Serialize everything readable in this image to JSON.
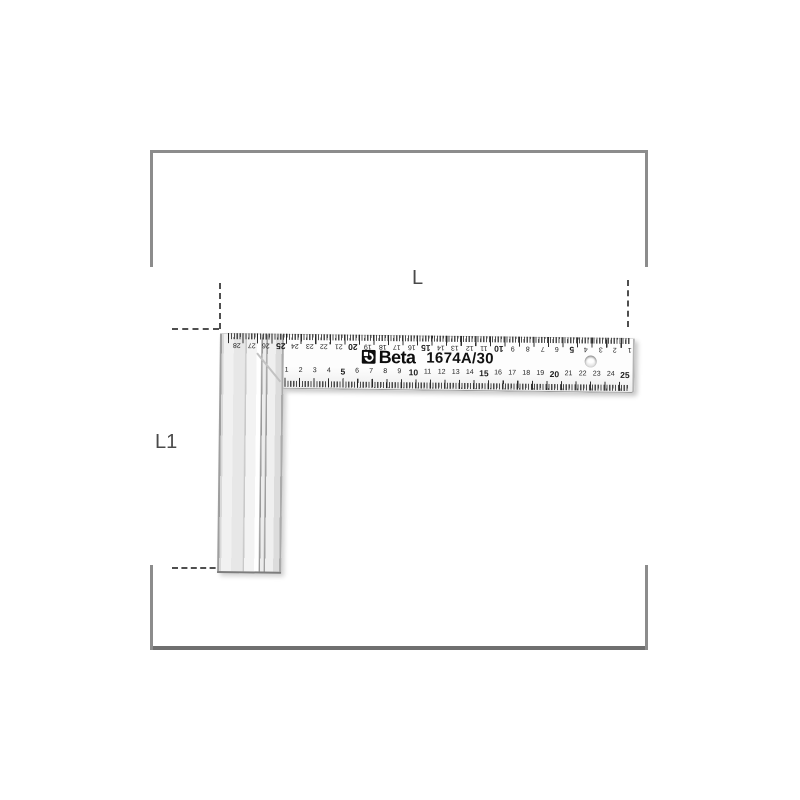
{
  "product": {
    "brand": "Beta",
    "model": "1674A/30"
  },
  "dimension_labels": {
    "length": "L",
    "height": "L1"
  },
  "ruler_scales": {
    "bottom_numbers": [
      1,
      2,
      3,
      4,
      5,
      6,
      7,
      8,
      9,
      10,
      11,
      12,
      13,
      14,
      15,
      16,
      17,
      18,
      19,
      20,
      21,
      22,
      23,
      24,
      25
    ],
    "top_numbers": [
      28,
      27,
      26,
      25,
      24,
      23,
      22,
      21,
      20,
      19,
      18,
      17,
      16,
      15,
      14,
      13,
      12,
      11,
      10,
      9,
      8,
      7,
      6,
      5,
      4,
      3,
      2,
      1
    ]
  },
  "icons": {
    "beta_logo": "beta-logo-icon",
    "hole": "hanging-hole"
  },
  "colors": {
    "frame_border": "#8c8c8c",
    "dashed_line": "#4f4f4f",
    "metal_light": "#f1f1f1",
    "text": "#111111"
  }
}
